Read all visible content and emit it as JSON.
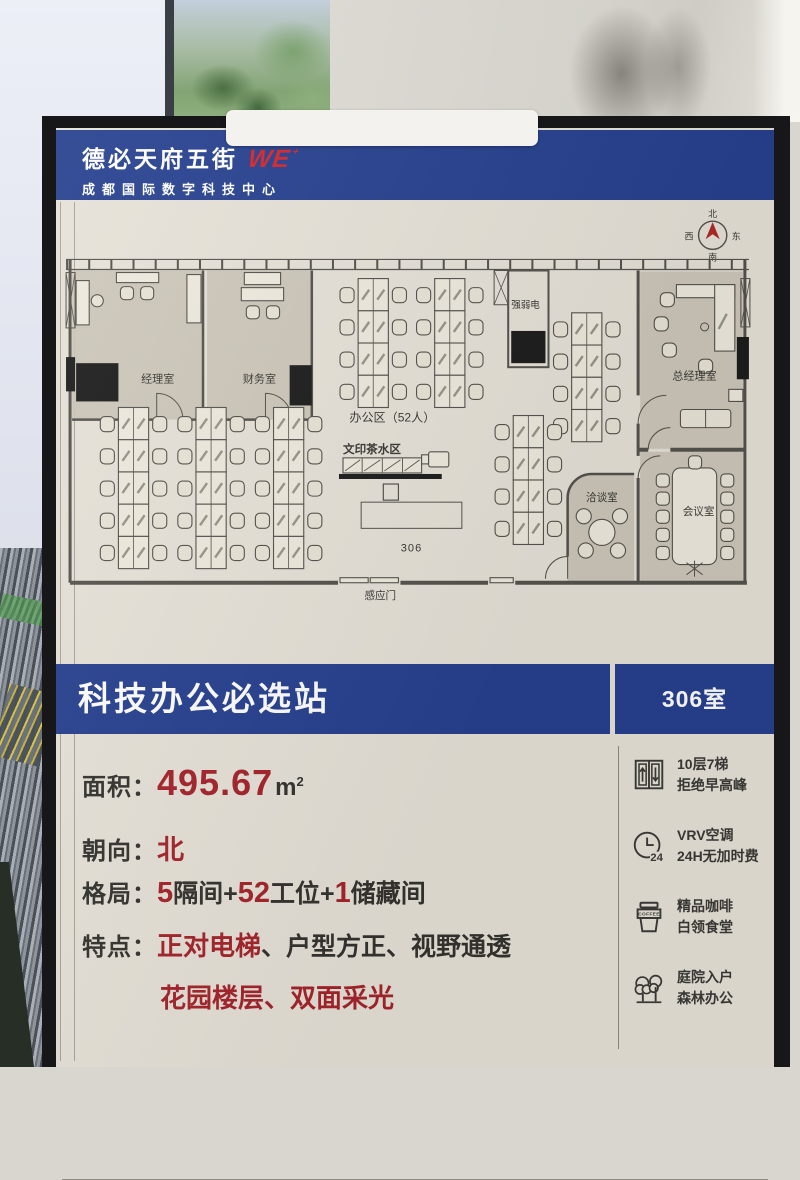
{
  "header": {
    "logo_cn": "德必天府五街",
    "logo_en": "WE",
    "logo_sup": "⁺",
    "subtitle": "成都国际数字科技中心"
  },
  "plan": {
    "compass": {
      "north": "北",
      "east": "东",
      "south": "南",
      "west": "西"
    },
    "labels": {
      "manager_office": "经理室",
      "finance_office": "财务室",
      "power_room": "强弱电",
      "gm_office": "总经理室",
      "office_area": "办公区（52人）",
      "print_tea_area": "文印茶水区",
      "talk_room": "洽谈室",
      "meeting_room": "会议室",
      "room_number": "306",
      "sensor_door": "感应门"
    }
  },
  "title_bar": {
    "title": "科技办公必选站",
    "room": "306室"
  },
  "details": {
    "area_label": "面积：",
    "area_value": "495.67",
    "area_unit": "m",
    "area_unit_sup": "2",
    "orientation_label": "朝向：",
    "orientation_value": "北",
    "layout_label": "格局：",
    "layout_n1": "5",
    "layout_t1": "隔间+",
    "layout_n2": "52",
    "layout_t2": "工位+",
    "layout_n3": "1",
    "layout_t3": "储藏间",
    "features_label": "特点：",
    "features_red_1": "正对电梯",
    "features_rest_1": "、户型方正、视野通透",
    "features_red_2": "花园楼层、双面采光"
  },
  "amenities": [
    {
      "icon": "elevator-icon",
      "line1": "10层7梯",
      "line2": "拒绝早高峰"
    },
    {
      "icon": "clock-24h-icon",
      "badge": "24",
      "line1": "VRV空调",
      "line2": "24H无加时费"
    },
    {
      "icon": "coffee-icon",
      "badge": "COFFEE",
      "line1": "精品咖啡",
      "line2": "白领食堂"
    },
    {
      "icon": "trees-icon",
      "line1": "庭院入户",
      "line2": "森林办公"
    }
  ],
  "colors": {
    "brand_blue": "#27418f",
    "accent_red": "#a5242b",
    "logo_red": "#d4262b",
    "poster_cream": "#e7e2d8",
    "frame_black": "#17171a"
  }
}
